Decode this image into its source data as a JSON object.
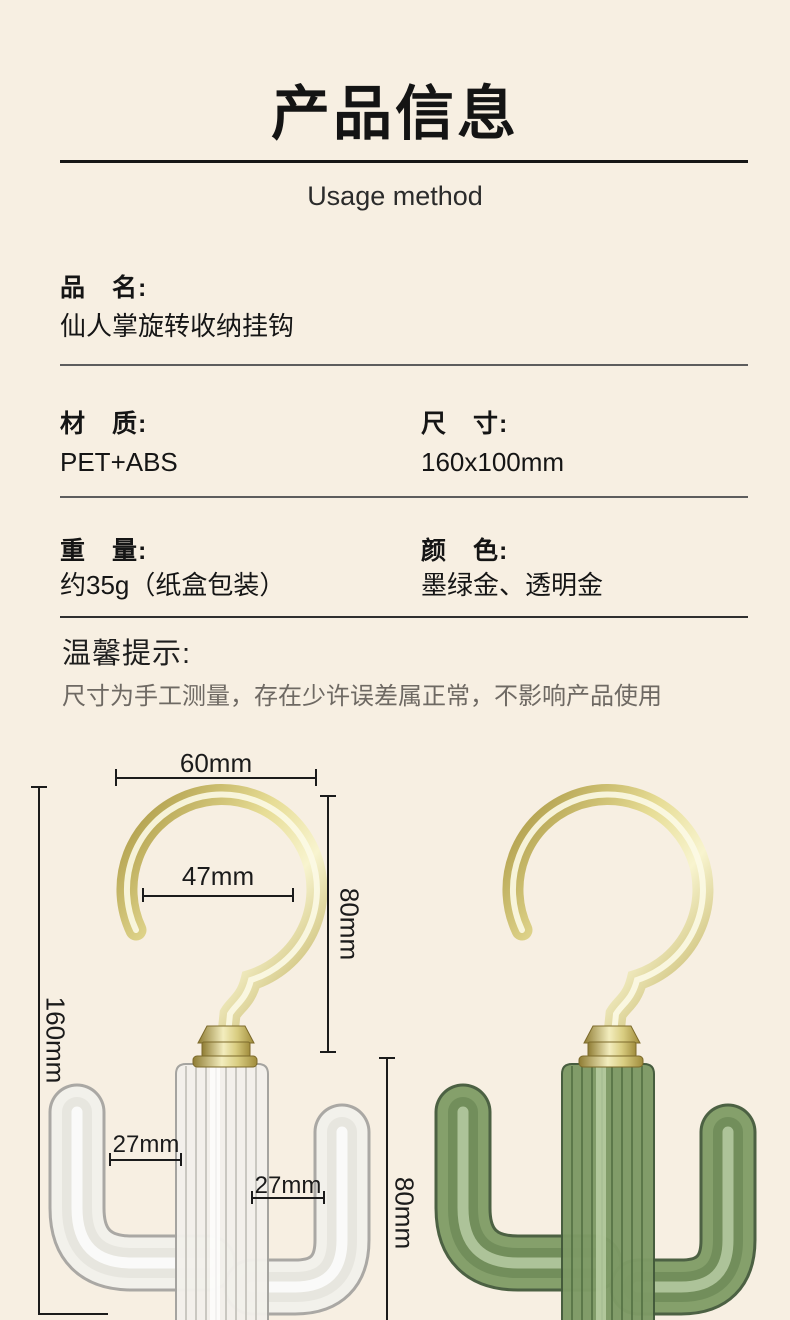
{
  "page": {
    "background": "#f7efe2",
    "gold": "#d8cc7e",
    "green": "#7e9a66",
    "measure_line_color": "#1b1b1b"
  },
  "header": {
    "title": "产品信息",
    "subtitle": "Usage method"
  },
  "specs": {
    "name": {
      "label": "品　名:",
      "value": "仙人掌旋转收纳挂钩"
    },
    "material": {
      "label": "材　质:",
      "value": "PET+ABS"
    },
    "size": {
      "label": "尺　寸:",
      "value": "160x100mm"
    },
    "weight": {
      "label": "重　量:",
      "value": "约35g（纸盒包装）"
    },
    "color": {
      "label": "颜　色:",
      "value": "墨绿金、透明金"
    }
  },
  "notice": {
    "title": "温馨提示:",
    "text": "尺寸为手工测量，存在少许误差属正常，不影响产品使用"
  },
  "diagram": {
    "hook_outer_width": "60mm",
    "hook_inner_width": "47mm",
    "hook_height": "80mm",
    "overall_height": "160mm",
    "left_arm_gap": "27mm",
    "right_arm_gap": "27mm",
    "body_height": "80mm"
  }
}
